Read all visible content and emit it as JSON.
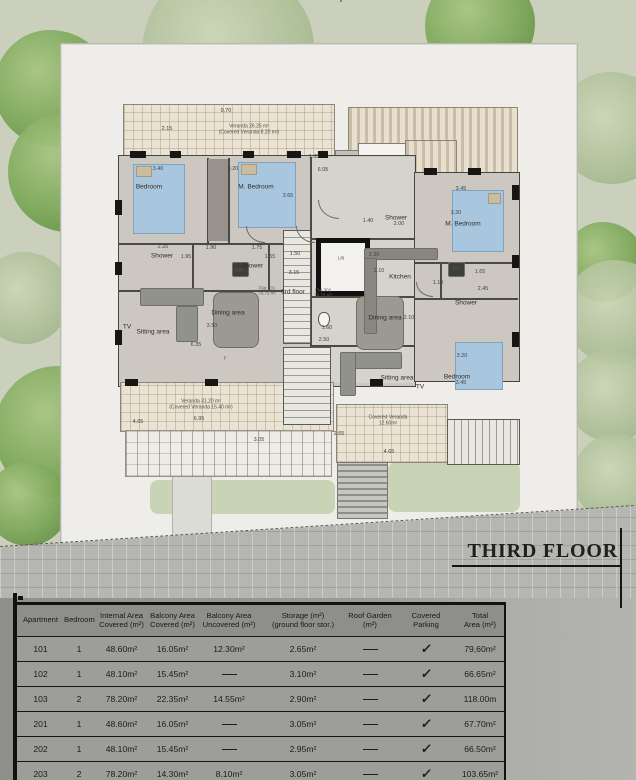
{
  "title_block": {
    "label": "THIRD FLOOR"
  },
  "table": {
    "columns": [
      {
        "l1": "Apartment",
        "l2": "",
        "w": 47
      },
      {
        "l1": "Bedroom",
        "l2": "",
        "w": 30
      },
      {
        "l1": "Internal Area",
        "l2": "Covered (m²)",
        "w": 55
      },
      {
        "l1": "Balcony Area",
        "l2": "Covered (m²)",
        "w": 47
      },
      {
        "l1": "Balcony Area",
        "l2": "Uncovered (m²)",
        "w": 66
      },
      {
        "l1": "Storage (m²)",
        "l2": "(ground floor stor.)",
        "w": 82
      },
      {
        "l1": "Roof Garden",
        "l2": "(m²)",
        "w": 52
      },
      {
        "l1": "Covered",
        "l2": "Parking",
        "w": 60
      },
      {
        "l1": "Total",
        "l2": "Area (m²)",
        "w": 48
      }
    ],
    "rows": [
      {
        "cells": [
          "101",
          "1",
          "48.60m²",
          "16.05m²",
          "12.30m²",
          "2.65m²",
          "—",
          "✓",
          "79,60m²"
        ]
      },
      {
        "cells": [
          "102",
          "1",
          "48.10m²",
          "15.45m²",
          "—",
          "3.10m²",
          "—",
          "✓",
          "66.65m²"
        ]
      },
      {
        "cells": [
          "103",
          "2",
          "78.20m²",
          "22.35m²",
          "14.55m²",
          "2.90m²",
          "—",
          "✓",
          "118.00m"
        ]
      },
      {
        "cells": [
          "201",
          "1",
          "48.60m²",
          "16.05m²",
          "—",
          "3.05m²",
          "—",
          "✓",
          "67.70m²"
        ]
      },
      {
        "cells": [
          "202",
          "1",
          "48.10m²",
          "15.45m²",
          "—",
          "2.95m²",
          "—",
          "✓",
          "66.50m²"
        ]
      },
      {
        "cells": [
          "203",
          "2",
          "78.20m²",
          "14.30m²",
          "8.10m²",
          "3.05m²",
          "—",
          "✓",
          "103.65m²"
        ]
      }
    ],
    "partial_row": {
      "cells": [
        "",
        "",
        "",
        "",
        "",
        "",
        "55.70m²",
        "✓",
        ""
      ]
    }
  },
  "plan": {
    "labels": [
      {
        "t": "Bedroom",
        "x": 149,
        "y": 187,
        "c": "room"
      },
      {
        "t": "M. Bedroom",
        "x": 256,
        "y": 187,
        "c": "room"
      },
      {
        "t": "M. Bedroom",
        "x": 463,
        "y": 224,
        "c": "room"
      },
      {
        "t": "Bedroom",
        "x": 457,
        "y": 377,
        "c": "room"
      },
      {
        "t": "Shower",
        "x": 162,
        "y": 256,
        "c": "room"
      },
      {
        "t": "Shower",
        "x": 252,
        "y": 266,
        "c": "room"
      },
      {
        "t": "Shower",
        "x": 396,
        "y": 218,
        "c": "room"
      },
      {
        "t": "Shower",
        "x": 466,
        "y": 303,
        "c": "room"
      },
      {
        "t": "Kitchen",
        "x": 400,
        "y": 277,
        "c": "room"
      },
      {
        "t": "Dining area",
        "x": 228,
        "y": 313,
        "c": "room"
      },
      {
        "t": "Sitting area",
        "x": 153,
        "y": 332,
        "c": "room"
      },
      {
        "t": "Dining area",
        "x": 385,
        "y": 318,
        "c": "room"
      },
      {
        "t": "Sitting area",
        "x": 397,
        "y": 378,
        "c": "room"
      },
      {
        "t": "TV",
        "x": 127,
        "y": 327,
        "c": "room"
      },
      {
        "t": "TV",
        "x": 420,
        "y": 387,
        "c": "room"
      },
      {
        "t": "WM",
        "x": 239,
        "y": 270,
        "c": "tiny"
      },
      {
        "t": "WM",
        "x": 456,
        "y": 268,
        "c": "tiny"
      },
      {
        "t": "Lift",
        "x": 341,
        "y": 258,
        "c": "tiny"
      },
      {
        "t": "F",
        "x": 225,
        "y": 358,
        "c": "tiny"
      },
      {
        "t": "3rd floor",
        "x": 293,
        "y": 292,
        "c": "room"
      },
      {
        "t": "Flat 301",
        "t2": "78.75 m²",
        "x": 267,
        "y": 291,
        "c": "tiny"
      },
      {
        "t": "Flat 302",
        "t2": "78.75 m²",
        "x": 323,
        "y": 293,
        "c": "tiny"
      },
      {
        "t": "Veranda 26.25 m²",
        "t2": "(Covered Veranda 8.20 m²)",
        "x": 249,
        "y": 130,
        "c": "note"
      },
      {
        "t": "Veranda 31.20 m²",
        "t2": "(Covered Veranda 15.40 m²)",
        "x": 201,
        "y": 405,
        "c": "note"
      },
      {
        "t": "Covered Veranda",
        "t2": "12.60m²",
        "x": 388,
        "y": 421,
        "c": "note"
      },
      {
        "t": "9.70",
        "x": 226,
        "y": 111,
        "c": "dim"
      },
      {
        "t": "2.15",
        "x": 167,
        "y": 129,
        "c": "dim"
      },
      {
        "t": "3.40",
        "x": 158,
        "y": 169,
        "c": "dim"
      },
      {
        "t": "3.20",
        "x": 233,
        "y": 169,
        "c": "dim"
      },
      {
        "t": "3.65",
        "x": 288,
        "y": 196,
        "c": "dim"
      },
      {
        "t": "1.35",
        "x": 314,
        "y": 157,
        "c": "dim"
      },
      {
        "t": "6.05",
        "x": 323,
        "y": 170,
        "c": "dim"
      },
      {
        "t": "3.45",
        "x": 461,
        "y": 189,
        "c": "dim"
      },
      {
        "t": "3.20",
        "x": 456,
        "y": 213,
        "c": "dim"
      },
      {
        "t": "2.20",
        "x": 163,
        "y": 247,
        "c": "dim"
      },
      {
        "t": "1.90",
        "x": 211,
        "y": 248,
        "c": "dim"
      },
      {
        "t": "1.75",
        "x": 257,
        "y": 248,
        "c": "dim"
      },
      {
        "t": "1.95",
        "x": 186,
        "y": 257,
        "c": "dim"
      },
      {
        "t": "1.40",
        "x": 368,
        "y": 221,
        "c": "dim"
      },
      {
        "t": "2.00",
        "x": 399,
        "y": 224,
        "c": "dim"
      },
      {
        "t": "1.55",
        "x": 270,
        "y": 257,
        "c": "dim"
      },
      {
        "t": "1.50",
        "x": 295,
        "y": 254,
        "c": "dim"
      },
      {
        "t": "3.15",
        "x": 294,
        "y": 273,
        "c": "dim"
      },
      {
        "t": "2.30",
        "x": 374,
        "y": 255,
        "c": "dim"
      },
      {
        "t": "2.10",
        "x": 379,
        "y": 271,
        "c": "dim"
      },
      {
        "t": "1.10",
        "x": 438,
        "y": 283,
        "c": "dim"
      },
      {
        "t": "1.65",
        "x": 480,
        "y": 272,
        "c": "dim"
      },
      {
        "t": "2.45",
        "x": 483,
        "y": 289,
        "c": "dim"
      },
      {
        "t": "1.60",
        "x": 327,
        "y": 328,
        "c": "dim"
      },
      {
        "t": "2.50",
        "x": 324,
        "y": 340,
        "c": "dim"
      },
      {
        "t": "6.35",
        "x": 196,
        "y": 345,
        "c": "dim"
      },
      {
        "t": "3.50",
        "x": 212,
        "y": 326,
        "c": "dim"
      },
      {
        "t": "2.10",
        "x": 409,
        "y": 318,
        "c": "dim"
      },
      {
        "t": "3.20",
        "x": 462,
        "y": 356,
        "c": "dim"
      },
      {
        "t": "3.45",
        "x": 461,
        "y": 383,
        "c": "dim"
      },
      {
        "t": "6.95",
        "x": 199,
        "y": 419,
        "c": "dim"
      },
      {
        "t": "4.65",
        "x": 138,
        "y": 422,
        "c": "dim"
      },
      {
        "t": "3.05",
        "x": 259,
        "y": 440,
        "c": "dim"
      },
      {
        "t": "2.65",
        "x": 339,
        "y": 434,
        "c": "dim"
      },
      {
        "t": "4.65",
        "x": 389,
        "y": 452,
        "c": "dim"
      }
    ]
  },
  "scene": {
    "trees": [
      {
        "x": 52,
        "y": 88,
        "r": 58,
        "k": "b"
      },
      {
        "x": 68,
        "y": 172,
        "r": 60,
        "k": "b"
      },
      {
        "x": 228,
        "y": 52,
        "r": 86,
        "k": "p"
      },
      {
        "x": 480,
        "y": 26,
        "r": 55,
        "k": "b"
      },
      {
        "x": 612,
        "y": 128,
        "r": 56,
        "k": "p"
      },
      {
        "x": 604,
        "y": 262,
        "r": 40,
        "k": "b"
      },
      {
        "x": 616,
        "y": 312,
        "r": 52,
        "k": "p"
      },
      {
        "x": 612,
        "y": 396,
        "r": 46,
        "k": "p"
      },
      {
        "x": 617,
        "y": 478,
        "r": 44,
        "k": "p"
      },
      {
        "x": 25,
        "y": 298,
        "r": 46,
        "k": "p"
      },
      {
        "x": 120,
        "y": 452,
        "r": 52,
        "k": "p"
      },
      {
        "x": 60,
        "y": 432,
        "r": 66,
        "k": "b"
      },
      {
        "x": 28,
        "y": 504,
        "r": 42,
        "k": "b"
      },
      {
        "x": 160,
        "y": 497,
        "r": 14,
        "k": "s"
      },
      {
        "x": 196,
        "y": 503,
        "r": 16,
        "k": "s"
      },
      {
        "x": 232,
        "y": 498,
        "r": 14,
        "k": "s"
      },
      {
        "x": 268,
        "y": 503,
        "r": 15,
        "k": "s"
      },
      {
        "x": 301,
        "y": 498,
        "r": 13,
        "k": "s"
      },
      {
        "x": 430,
        "y": 482,
        "r": 16,
        "k": "s"
      },
      {
        "x": 464,
        "y": 487,
        "r": 17,
        "k": "s"
      },
      {
        "x": 498,
        "y": 479,
        "r": 15,
        "k": "s"
      },
      {
        "x": 396,
        "y": 492,
        "r": 12,
        "k": "t"
      },
      {
        "x": 535,
        "y": 470,
        "r": 12,
        "k": "s"
      }
    ]
  }
}
